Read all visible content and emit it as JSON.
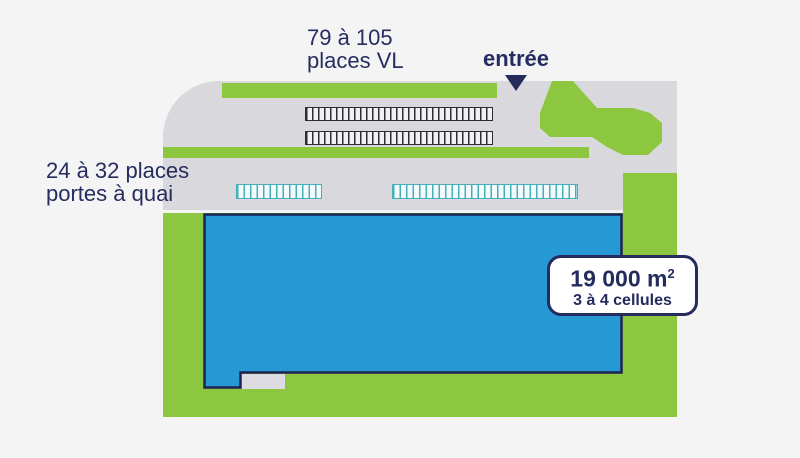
{
  "diagram": {
    "type": "warehouse-site-plan",
    "labels": {
      "vl_places": {
        "line1": "79 à 105",
        "line2": "places VL"
      },
      "entrance": "entrée",
      "dock_places": {
        "line1": "24 à 32 places",
        "line2": "portes à quai"
      }
    },
    "badge": {
      "area_value": "19 000 m",
      "area_sup": "2",
      "cells": "3 à 4 cellules"
    },
    "icons": {
      "entrance_arrow": "triangle-down-icon"
    },
    "colors": {
      "page_background": "#f4f4f5",
      "plot_gray": "#d9d9dd",
      "landscape_green": "#8dc63f",
      "building_blue": "#2698d4",
      "outline_navy": "#1d2453",
      "text_navy": "#262d5e",
      "dock_teal": "#47aebc",
      "parking_dark": "#2c2c34",
      "badge_background": "#ffffff"
    }
  }
}
